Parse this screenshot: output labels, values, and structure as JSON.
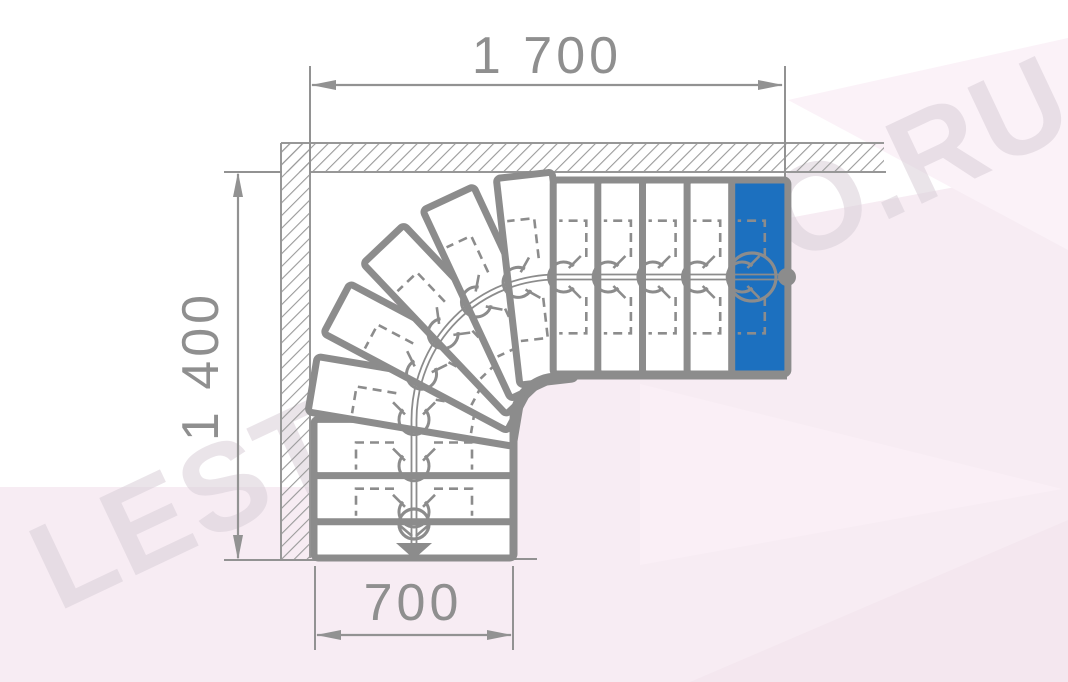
{
  "drawing": {
    "title": "quarter-turn-winder-staircase-plan",
    "watermark": {
      "text": "LESTNICAPRO.RU"
    },
    "dimensions": {
      "top": "1 700",
      "left": "1 400",
      "bottom": "700"
    },
    "steps": {
      "count": 13,
      "highlighted_step": 13
    },
    "colors": {
      "step_line": "#8c8c8c",
      "dim_line": "#929292",
      "dim_text": "#8f8f8f",
      "hatch": "#9a9a9a",
      "blue_step": "#1c70bf",
      "pink_base": "#f7ecf3",
      "pink_light": "#fbf2f8",
      "pink_ray": "#faeff6",
      "pink_dark": "#f4e7ef",
      "watermark": "#d9cfd8"
    }
  }
}
